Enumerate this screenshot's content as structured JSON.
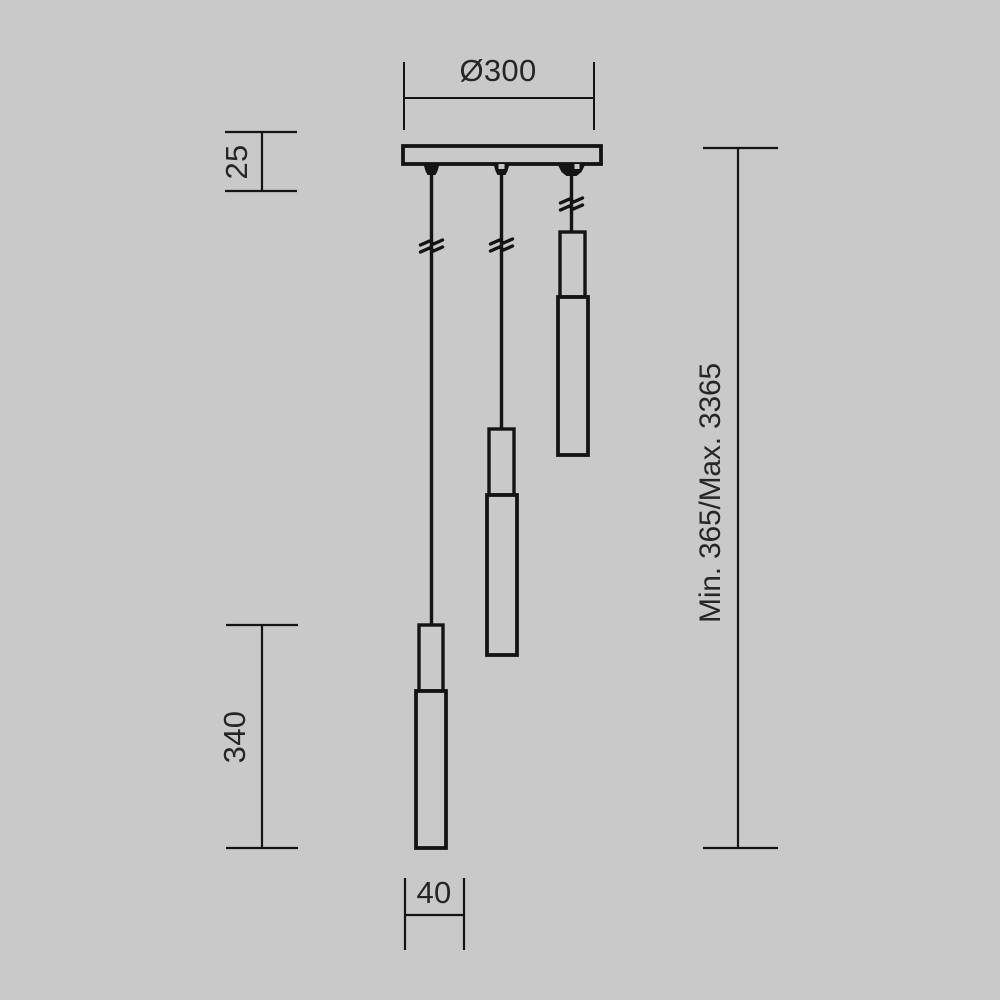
{
  "colors": {
    "background": "#c9c9c9",
    "line": "#141414",
    "text": "#262626"
  },
  "diagram": {
    "labels": {
      "canopy_diameter": "Ø300",
      "canopy_thickness": "25",
      "pendant_length": "340",
      "pendant_width": "40",
      "height_range": "Min. 365/Max. 3365"
    }
  }
}
